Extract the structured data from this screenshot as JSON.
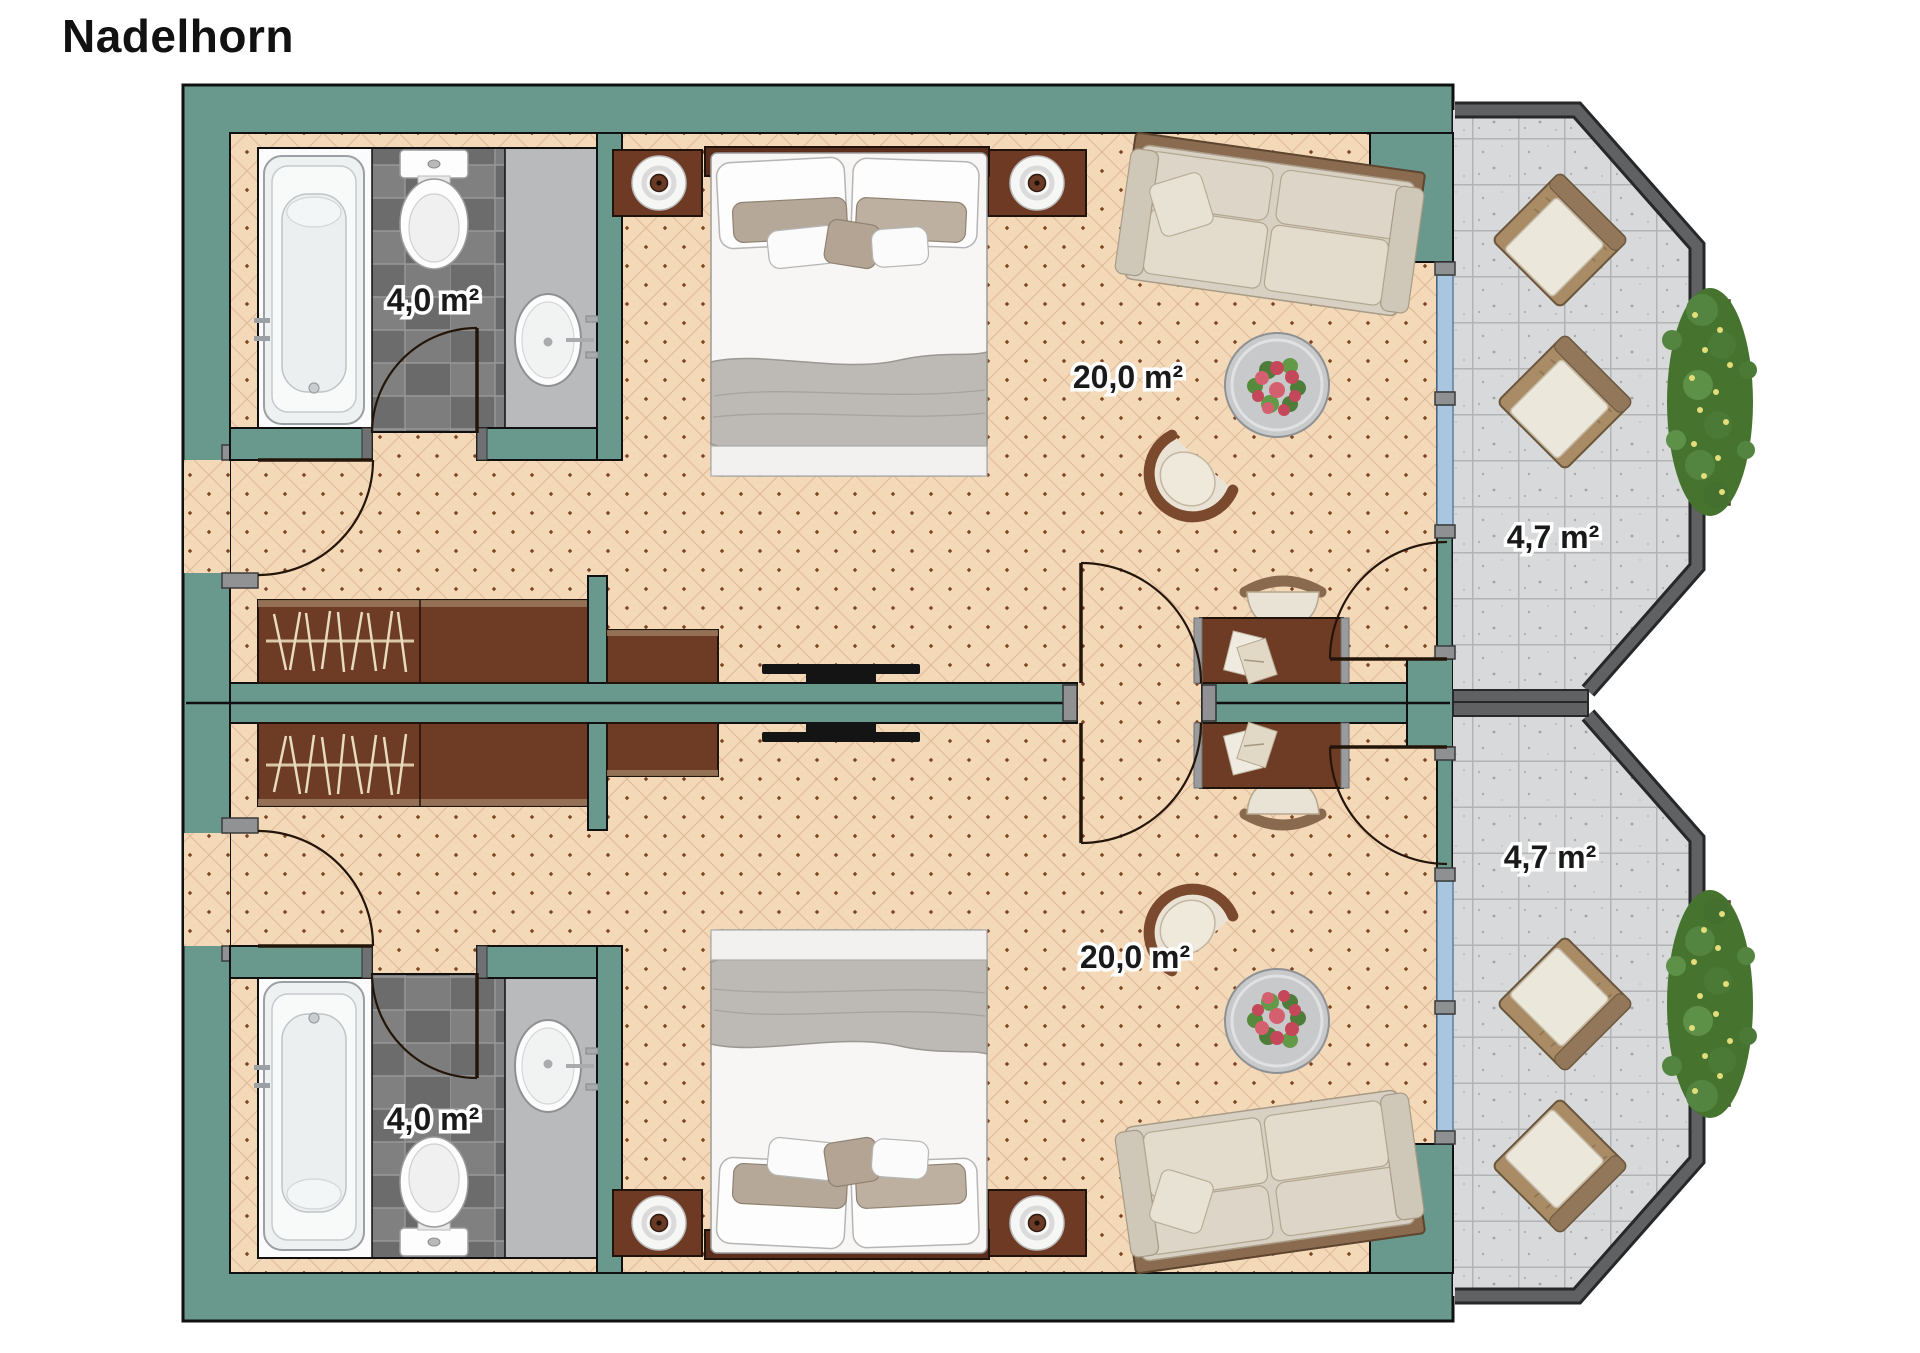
{
  "title": "Nadelhorn",
  "floorplan": {
    "units": [
      {
        "name": "room-top",
        "area_label": "20,0 m²",
        "bathroom_area_label": "4,0 m²",
        "balcony_area_label": "4,7 m²"
      },
      {
        "name": "room-bottom",
        "area_label": "20,0 m²",
        "bathroom_area_label": "4,0 m²",
        "balcony_area_label": "4,7 m²"
      }
    ],
    "colors": {
      "wall_teal": "#68998c",
      "wall_outline": "#101010",
      "floor_tan": "#f4d9b9",
      "floor_dot_brown": "#7e4422",
      "bathroom_tile_gray": "#747474",
      "counter_gray": "#b9babb",
      "balcony_concrete": "#d8d9da",
      "railing_gray": "#5f6163",
      "glazing_blue": "#a9c6e0",
      "furniture_wood_brown": "#6b3a23",
      "sofa_beige": "#d8d0c2",
      "hedge_green": "#46742f",
      "flower_red": "#c4485a",
      "label_color": "#1a1a1a"
    }
  }
}
